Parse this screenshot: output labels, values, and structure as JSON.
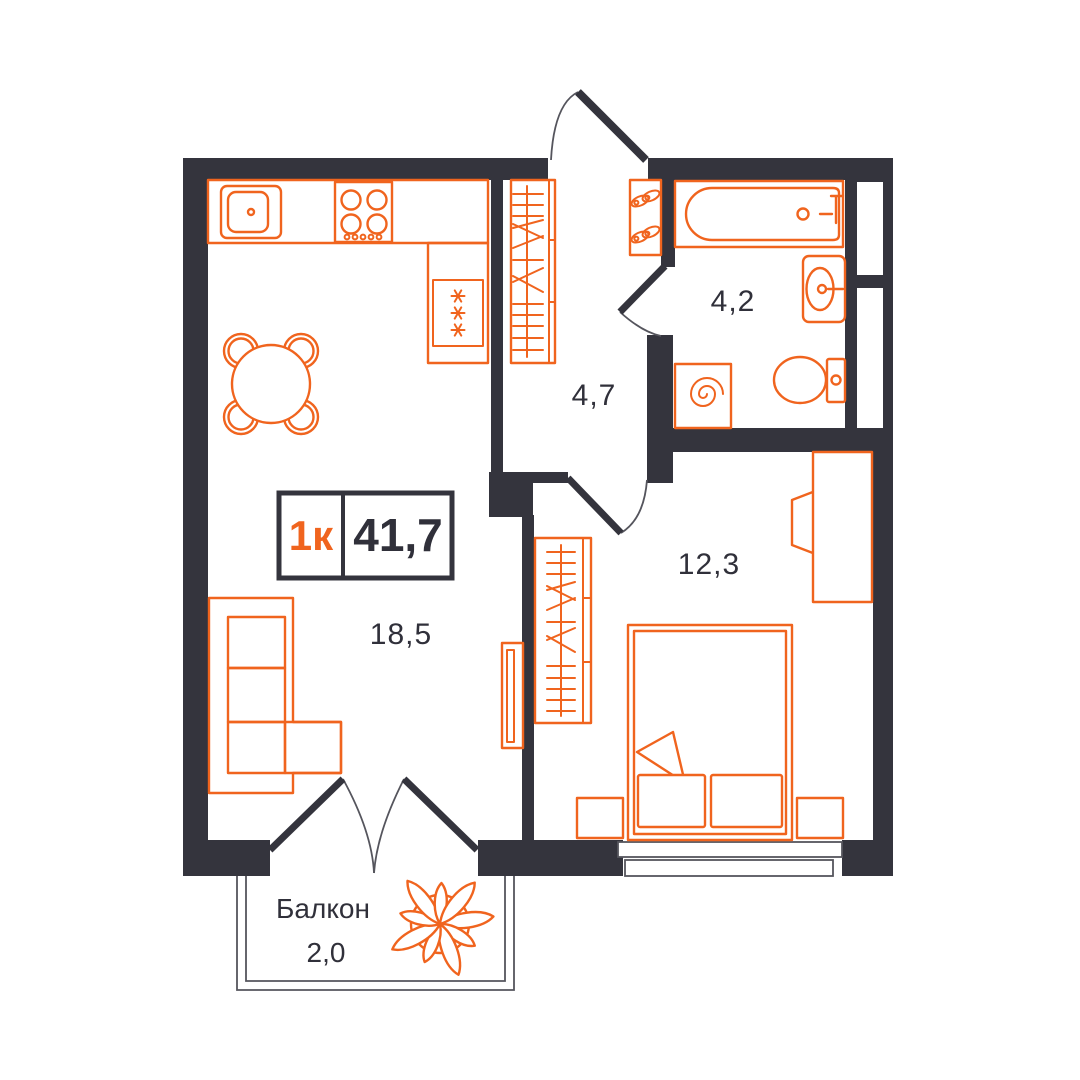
{
  "plan": {
    "badge": {
      "rooms_label": "1к",
      "area_label": "41,7"
    },
    "rooms": [
      {
        "id": "kitchen-living",
        "area_label": "18,5"
      },
      {
        "id": "hallway",
        "area_label": "4,7"
      },
      {
        "id": "bathroom",
        "area_label": "4,2"
      },
      {
        "id": "bedroom",
        "area_label": "12,3"
      },
      {
        "id": "balcony",
        "name": "Балкон",
        "area_label": "2,0"
      }
    ],
    "colors": {
      "wall": "#34343D",
      "furniture": "#F0641E",
      "text": "#30303A",
      "thin_line": "#55555D",
      "background": "#FFFFFF"
    },
    "symbols": {
      "kitchen_sink": "kitchen-sink-icon",
      "stove": "stove-icon",
      "fridge": "fridge-icon",
      "dining_table": "dining-table-icon",
      "wardrobe": "wardrobe-icon",
      "shoe_rack": "shoe-rack-icon",
      "bathtub": "bathtub-icon",
      "washbasin": "washbasin-icon",
      "toilet": "toilet-icon",
      "washing_machine": "washing-machine-icon",
      "bed": "bed-icon",
      "nightstand": "nightstand-icon",
      "desk": "desk-icon",
      "tv": "tv-icon",
      "sofa": "sofa-icon",
      "plant": "plant-icon",
      "door": "door-swing-icon",
      "window": "window-icon"
    }
  }
}
